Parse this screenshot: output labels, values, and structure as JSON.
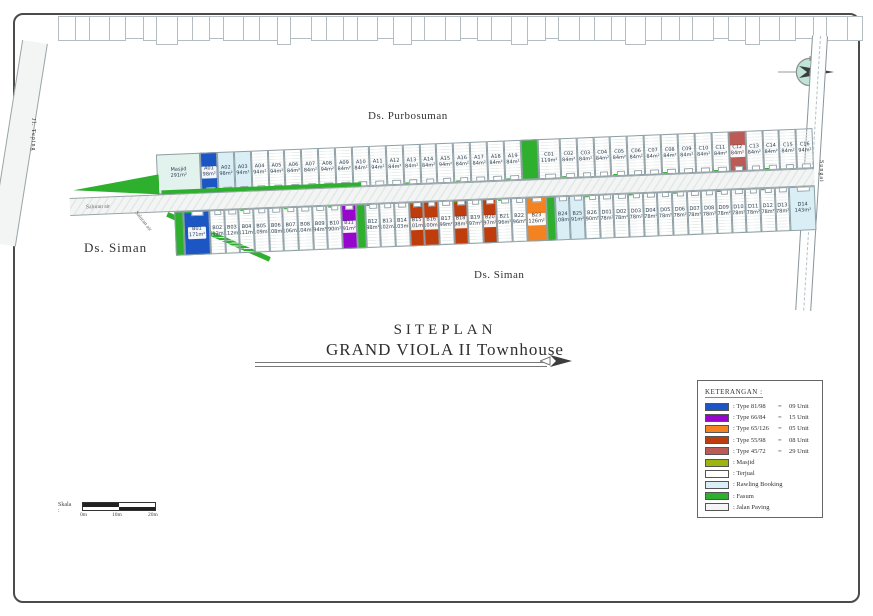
{
  "title": {
    "line1": "SITEPLAN",
    "line2": "GRAND VIOLA II Townhouse"
  },
  "map": {
    "region_labels": {
      "north": "Ds. Purbosuman",
      "west": "Ds. Siman",
      "south": "Ds. Siman"
    },
    "road_labels": {
      "left_road": "Jl. Teping",
      "right_river": "Sungai",
      "canal_a": "Saluran air",
      "canal_b": "Saluran air"
    },
    "top_row": [
      {
        "code": "Masjid",
        "area": "291m²",
        "status": "masjid",
        "w": 44
      },
      {
        "code": "A01",
        "area": "98m²",
        "status": "t8198"
      },
      {
        "code": "A02",
        "area": "98m²",
        "status": "booking"
      },
      {
        "code": "A03",
        "area": "94m²",
        "status": "booking"
      },
      {
        "code": "A04",
        "area": "94m²",
        "status": "sold"
      },
      {
        "code": "A05",
        "area": "94m²",
        "status": "sold"
      },
      {
        "code": "A06",
        "area": "84m²",
        "status": "sold"
      },
      {
        "code": "A07",
        "area": "84m²",
        "status": "sold"
      },
      {
        "code": "A08",
        "area": "94m²",
        "status": "sold"
      },
      {
        "code": "A09",
        "area": "84m²",
        "status": "sold"
      },
      {
        "code": "A10",
        "area": "84m²",
        "status": "sold"
      },
      {
        "code": "A11",
        "area": "94m²",
        "status": "sold"
      },
      {
        "code": "A12",
        "area": "84m²",
        "status": "sold"
      },
      {
        "code": "A13",
        "area": "84m²",
        "status": "sold"
      },
      {
        "code": "A14",
        "area": "84m²",
        "status": "sold"
      },
      {
        "code": "A15",
        "area": "94m²",
        "status": "sold"
      },
      {
        "code": "A16",
        "area": "84m²",
        "status": "sold"
      },
      {
        "code": "A17",
        "area": "84m²",
        "status": "sold"
      },
      {
        "code": "A18",
        "area": "84m²",
        "status": "sold"
      },
      {
        "code": "A19",
        "area": "84m²",
        "status": "sold"
      },
      {
        "code": "",
        "area": "",
        "status": "fasum"
      },
      {
        "code": "C01",
        "area": "119m²",
        "status": "sold",
        "w": 22
      },
      {
        "code": "C02",
        "area": "84m²",
        "status": "sold"
      },
      {
        "code": "C03",
        "area": "84m²",
        "status": "sold"
      },
      {
        "code": "C04",
        "area": "84m²",
        "status": "sold"
      },
      {
        "code": "C05",
        "area": "84m²",
        "status": "sold"
      },
      {
        "code": "C06",
        "area": "84m²",
        "status": "sold"
      },
      {
        "code": "C07",
        "area": "84m²",
        "status": "sold"
      },
      {
        "code": "C08",
        "area": "84m²",
        "status": "sold"
      },
      {
        "code": "C09",
        "area": "84m²",
        "status": "sold"
      },
      {
        "code": "C10",
        "area": "84m²",
        "status": "sold"
      },
      {
        "code": "C11",
        "area": "84m²",
        "status": "sold"
      },
      {
        "code": "C12",
        "area": "84m²",
        "status": "t4572"
      },
      {
        "code": "C13",
        "area": "84m²",
        "status": "sold"
      },
      {
        "code": "C14",
        "area": "84m²",
        "status": "sold"
      },
      {
        "code": "C15",
        "area": "84m²",
        "status": "sold"
      },
      {
        "code": "C16",
        "area": "94m²",
        "status": "sold"
      }
    ],
    "bottom_row": [
      {
        "code": "",
        "area": "",
        "status": "fasum",
        "w": 9
      },
      {
        "code": "B01",
        "area": "171m²",
        "status": "t8198",
        "w": 26
      },
      {
        "code": "B02",
        "area": "113m²",
        "status": "sold"
      },
      {
        "code": "B03",
        "area": "112m²",
        "status": "sold"
      },
      {
        "code": "B04",
        "area": "111m²",
        "status": "sold"
      },
      {
        "code": "B05",
        "area": "109m²",
        "status": "sold"
      },
      {
        "code": "B06",
        "area": "108m²",
        "status": "sold"
      },
      {
        "code": "B07",
        "area": "106m²",
        "status": "sold"
      },
      {
        "code": "B08",
        "area": "104m²",
        "status": "sold"
      },
      {
        "code": "B09",
        "area": "94m²",
        "status": "sold"
      },
      {
        "code": "B10",
        "area": "90m²",
        "status": "sold"
      },
      {
        "code": "B11",
        "area": "91m²",
        "status": "t6684"
      },
      {
        "code": "",
        "area": "",
        "status": "fasum",
        "w": 9
      },
      {
        "code": "B12",
        "area": "98m²",
        "status": "sold"
      },
      {
        "code": "B13",
        "area": "102m²",
        "status": "sold"
      },
      {
        "code": "B14",
        "area": "103m²",
        "status": "sold"
      },
      {
        "code": "B15",
        "area": "101m²",
        "status": "t5598"
      },
      {
        "code": "B16",
        "area": "100m²",
        "status": "t5598"
      },
      {
        "code": "B17",
        "area": "99m²",
        "status": "sold"
      },
      {
        "code": "B18",
        "area": "98m²",
        "status": "t5598"
      },
      {
        "code": "B19",
        "area": "97m²",
        "status": "sold"
      },
      {
        "code": "B20",
        "area": "97m²",
        "status": "t5598"
      },
      {
        "code": "B21",
        "area": "96m²",
        "status": "sold"
      },
      {
        "code": "B22",
        "area": "96m²",
        "status": "sold"
      },
      {
        "code": "B23",
        "area": "126m²",
        "status": "t65126",
        "w": 20
      },
      {
        "code": "",
        "area": "",
        "status": "fasum",
        "w": 9
      },
      {
        "code": "B24",
        "area": "108m²",
        "status": "booking"
      },
      {
        "code": "B25",
        "area": "91m²",
        "status": "booking"
      },
      {
        "code": "B26",
        "area": "90m²",
        "status": "sold"
      },
      {
        "code": "D01",
        "area": "78m²",
        "status": "sold"
      },
      {
        "code": "D02",
        "area": "78m²",
        "status": "sold"
      },
      {
        "code": "D03",
        "area": "78m²",
        "status": "sold"
      },
      {
        "code": "D04",
        "area": "78m²",
        "status": "sold"
      },
      {
        "code": "D05",
        "area": "78m²",
        "status": "sold"
      },
      {
        "code": "D06",
        "area": "78m²",
        "status": "sold"
      },
      {
        "code": "D07",
        "area": "78m²",
        "status": "sold"
      },
      {
        "code": "D08",
        "area": "78m²",
        "status": "sold"
      },
      {
        "code": "D09",
        "area": "78m²",
        "status": "sold"
      },
      {
        "code": "D10",
        "area": "78m²",
        "status": "sold"
      },
      {
        "code": "D11",
        "area": "78m²",
        "status": "sold"
      },
      {
        "code": "D12",
        "area": "78m²",
        "status": "sold"
      },
      {
        "code": "D13",
        "area": "78m²",
        "status": "sold"
      },
      {
        "code": "D14",
        "area": "143m²",
        "status": "booking",
        "w": 26
      }
    ]
  },
  "status_colors": {
    "t8198": "#1c56c4",
    "t6684": "#9706cd",
    "t65126": "#f58220",
    "t5598": "#bf3c0d",
    "t4572": "#bc5b55",
    "fasum": "#2eb02e",
    "booking": "#daeef5",
    "sold": "#ffffff",
    "masjid": "#e2f2ec"
  },
  "legend": {
    "title": "KETERANGAN :",
    "items": [
      {
        "label": ": Type 81/98",
        "eq": "=",
        "value": "09 Unit",
        "color": "#1c56c4",
        "hatched": false
      },
      {
        "label": ": Type 66/84",
        "eq": "=",
        "value": "15 Unit",
        "color": "#9706cd",
        "hatched": false
      },
      {
        "label": ": Type 65/126",
        "eq": "=",
        "value": "05 Unit",
        "color": "#f58220",
        "hatched": false
      },
      {
        "label": ": Type 55/98",
        "eq": "=",
        "value": "08 Unit",
        "color": "#bf3c0d",
        "hatched": false
      },
      {
        "label": ": Type 45/72",
        "eq": "=",
        "value": "29 Unit",
        "color": "#bc5b55",
        "hatched": false
      },
      {
        "label": ": Masjid",
        "eq": "",
        "value": "",
        "color": "#9db511",
        "hatched": true
      },
      {
        "label": ": Terjual",
        "eq": "",
        "value": "",
        "color": "#ffffff",
        "hatched": true
      },
      {
        "label": ": Rawling Booking",
        "eq": "",
        "value": "",
        "color": "#daeef5",
        "hatched": false
      },
      {
        "label": ": Fasum",
        "eq": "",
        "value": "",
        "color": "#2eb02e",
        "hatched": false
      },
      {
        "label": ": Jalan Paving",
        "eq": "",
        "value": "",
        "color": "#f4f6f5",
        "hatched": true
      }
    ]
  },
  "scale": {
    "label": "Skala :",
    "ticks": [
      "0m",
      "10m",
      "20m"
    ]
  }
}
